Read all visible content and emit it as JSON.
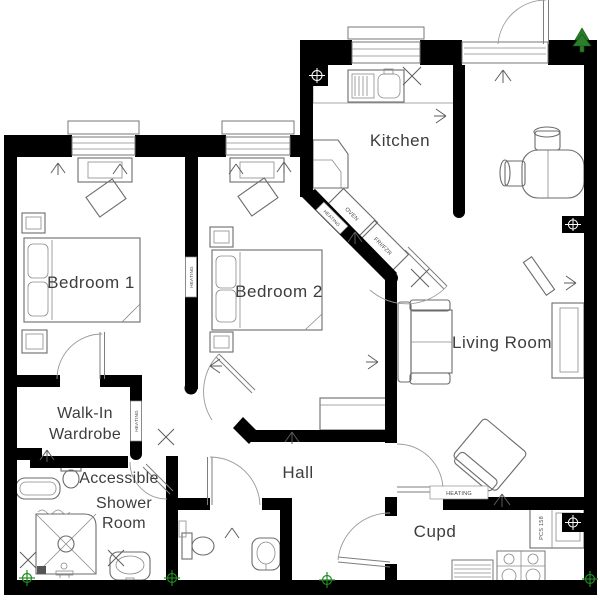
{
  "labels": {
    "bedroom1": "Bedroom 1",
    "bedroom2": "Bedroom 2",
    "kitchen": "Kitchen",
    "living_room": "Living Room",
    "hall": "Hall",
    "cupd": "Cupd",
    "walk_in_line1": "Walk-In",
    "walk_in_line2": "Wardrobe",
    "shower_line1": "Accessible",
    "shower_line2": "Shower",
    "shower_line3": "Room",
    "oven": "OVEN",
    "fridge_freezer": "FRI/FZR",
    "heating": "HEATING",
    "unit_code": "PCS 158"
  },
  "colors": {
    "wall": "#000000",
    "furniture_line": "#6b6b6b",
    "text": "#3d3d3d",
    "marker_green": "#1f8a1f"
  }
}
